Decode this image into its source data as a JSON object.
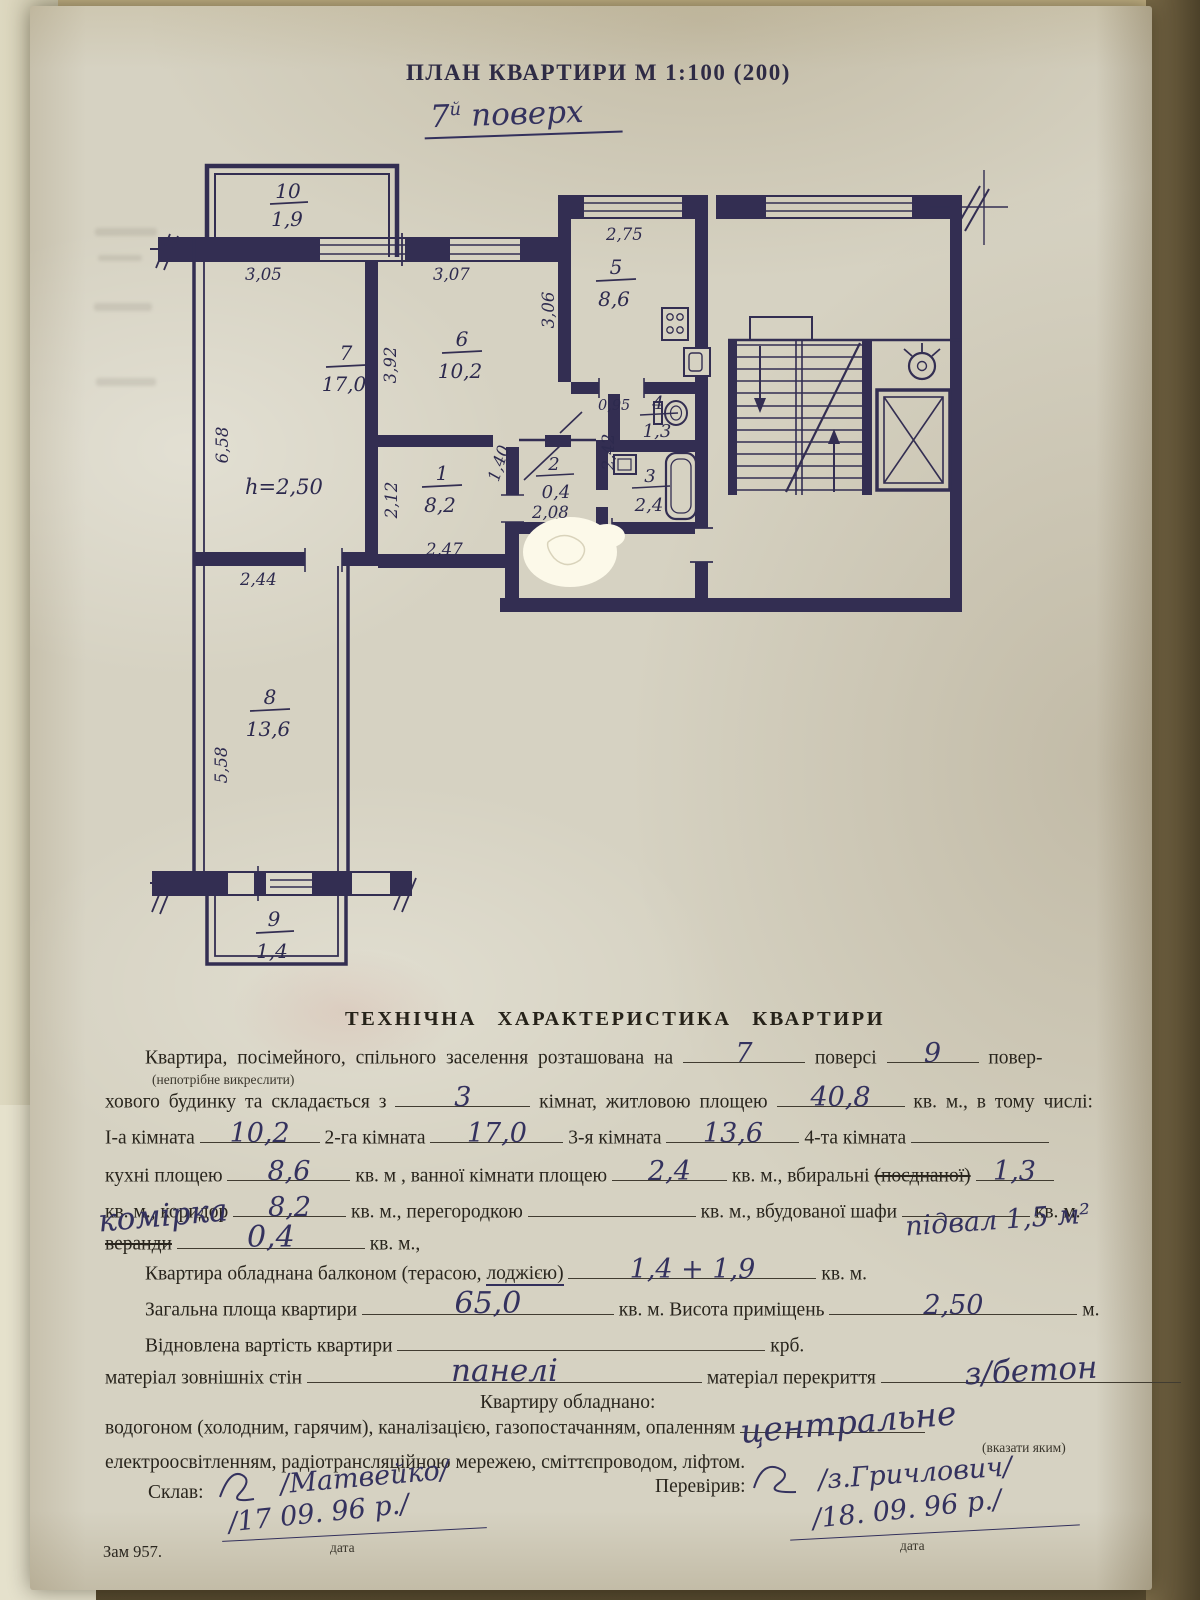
{
  "colors": {
    "ink": "#332e52",
    "blue_ink": "#41519f",
    "paper": "#d6d2c2",
    "print": "#29251d",
    "whiteout": "#fcf9e9"
  },
  "doc": {
    "title": "ПЛАН КВАРТИРИ М 1:100 (200)",
    "floor_num": "7",
    "floor_sup": "й",
    "floor_word": "поверх",
    "order_no": "Зам 957."
  },
  "plan": {
    "height_note": "h=2,50",
    "rooms": {
      "r1": {
        "num": "1",
        "area": "8,2"
      },
      "r2": {
        "num": "2",
        "area": "0,4"
      },
      "r3": {
        "num": "3",
        "area": "2,4"
      },
      "r4": {
        "num": "4",
        "area": "1,3"
      },
      "r5": {
        "num": "5",
        "area": "8,6"
      },
      "r6": {
        "num": "6",
        "area": "10,2"
      },
      "r7": {
        "num": "7",
        "area": "17,0"
      },
      "r8": {
        "num": "8",
        "area": "13,6"
      },
      "r9": {
        "num": "9",
        "area": "1,4"
      },
      "r10": {
        "num": "10",
        "area": "1,9"
      }
    },
    "dims": {
      "w305": "3,05",
      "w307": "3,07",
      "w275": "2,75",
      "h306": "3,06",
      "h392": "3,92",
      "h658": "6,58",
      "h212": "2,12",
      "d140": "1,40",
      "w095": "0,95",
      "h242": "2,42",
      "w208": "2,08",
      "w247": "2,47",
      "w244": "2,44",
      "h558": "5,58"
    }
  },
  "form": {
    "heading": "ТЕХНІЧНА ХАРАКТЕРИСТИКА КВАРТИРИ",
    "line1_pre": "Квартира, посімейного, спільного заселення розташована на",
    "line1_val": "7",
    "line1_mid": "поверсі",
    "line1_val2": "9",
    "line1_post": "повер-",
    "note1": "(непотрібне викреслити)",
    "line2_pre": "хового будинку та складається з",
    "line2_val": "3",
    "line2_mid": "кімнат, житловою площею",
    "line2_val2": "40,8",
    "line2_post": "кв. м., в тому числі:",
    "line3_l1": "І-а кімната",
    "line3_v1": "10,2",
    "line3_l2": "2-га кімната",
    "line3_v2": "17,0",
    "line3_l3": "3-я кімната",
    "line3_v3": "13,6",
    "line3_l4": "4-та кімната",
    "line4_l1": "кухні площею",
    "line4_v1": "8,6",
    "line4_l2": "кв. м , ванної кімнати площею",
    "line4_v2": "2,4",
    "line4_l3": "кв. м., вбиральні",
    "line4_l3s": "(поєднаної)",
    "line4_v3": "1,3",
    "line5_l1": "кв. м., коридор",
    "line5_v1": "8,2",
    "line5_l2": "кв. м., перегородкою",
    "line5_l3": "кв. м., вбудованої шафи",
    "line5_l4": "кв. м.",
    "line6_struck": "веранди",
    "line6_hand": "комірка",
    "line6_v": "0,4",
    "line6_post": "кв. м.,",
    "line6_note": "підвал 1,5 м²",
    "line7_pre": "Квартира обладнана балконом (терасою,",
    "line7_loggia": "лоджією)",
    "line7_v": "1,4 + 1,9",
    "line7_post": "кв. м.",
    "line8_pre": "Загальна площа квартири",
    "line8_v": "65,0",
    "line8_mid": "кв. м. Висота приміщень",
    "line8_v2": "2,50",
    "line8_post": "м.",
    "line9_pre": "Відновлена вартість квартири",
    "line9_post": "крб.",
    "line10_pre": "матеріал зовнішніх стін",
    "line10_v": "панелі",
    "line10_mid": "матеріал перекриття",
    "line10_v2": "з/бетон",
    "line11": "Квартиру обладнано:",
    "line12_pre": "водогоном (холодним, гарячим), каналізацією, газопостачанням, опаленням",
    "line12_v": "центральне",
    "note2": "(вказати яким)",
    "line13": "електроосвітленням, радіотрансляційною мережею, сміттєпроводом, ліфтом.",
    "sign1_label": "Склав:",
    "sign1_name": "/Матвейко/",
    "sign1_date": "/17 09. 96 р./",
    "sign2_label": "Перевірив:",
    "sign2_name": "/з.Гричлович/",
    "sign2_date": "/18. 09. 96 р./",
    "date_label1": "дата",
    "date_label2": "дата"
  }
}
